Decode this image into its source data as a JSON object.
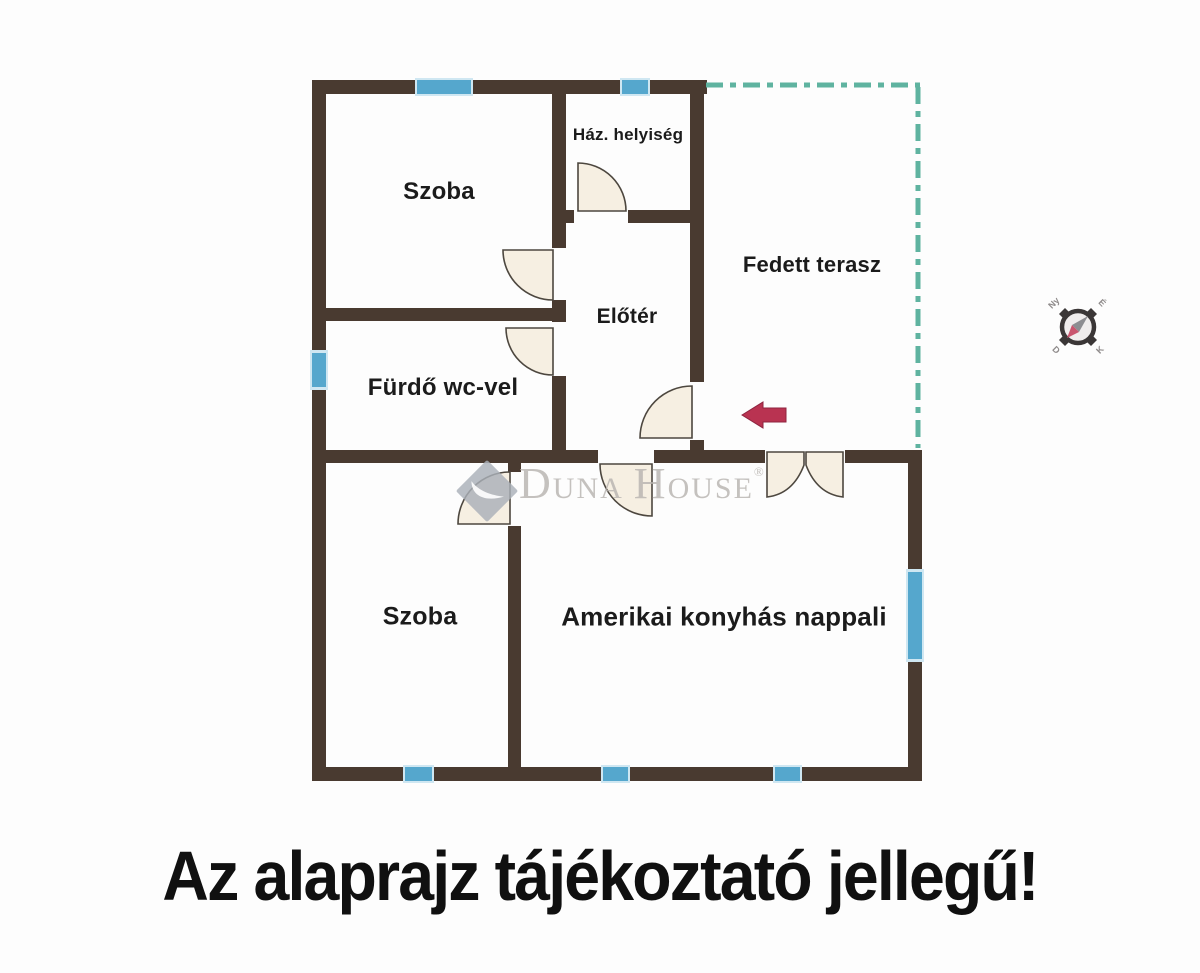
{
  "plan": {
    "rooms": {
      "szoba_top": {
        "label": "Szoba"
      },
      "haz_helyiseg": {
        "label": "Ház. helyiség"
      },
      "eloter": {
        "label": "Előtér"
      },
      "fedett_terasz": {
        "label": "Fedett terasz"
      },
      "furdo": {
        "label": "Fürdő wc-vel"
      },
      "szoba_bottom": {
        "label": "Szoba"
      },
      "nappali": {
        "label": "Amerikai konyhás nappali"
      }
    },
    "compass": {
      "ne": "É",
      "se": "K",
      "sw": "D",
      "nw": "Ny"
    },
    "colors": {
      "wall": "#493a30",
      "window": "#55a7cd",
      "window_frame": "#cfe7f2",
      "terrace_dash": "#5fb3a0",
      "door": "#f6efe2",
      "door_stroke": "#4d473f",
      "arrow": "#b93351",
      "text": "#1b1b1b",
      "watermark": "#b7b3af"
    }
  },
  "watermark": {
    "d": "D",
    "una": "UNA",
    "h": "H",
    "ouse": "OUSE",
    "reg": "®"
  },
  "disclaimer": {
    "text": "Az alaprajz tájékoztató jellegű!"
  }
}
